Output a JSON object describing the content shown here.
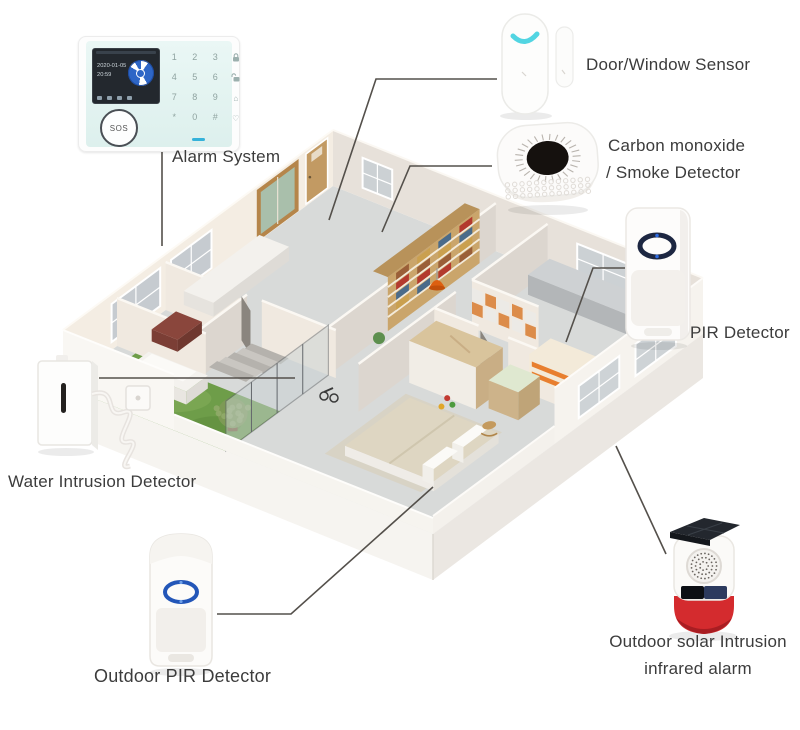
{
  "labels": {
    "alarm_system": "Alarm System",
    "door_window": "Door/Window Sensor",
    "co_line1": "Carbon monoxide",
    "co_line2": "/ Smoke Detector",
    "pir": "PIR Detector",
    "water": "Water Intrusion Detector",
    "outdoor_pir": "Outdoor PIR Detector",
    "solar_line1": "Outdoor solar Intrusion",
    "solar_line2": "infrared alarm"
  },
  "alarm_panel": {
    "screen_date": "2020-01-05",
    "screen_time": "20:59",
    "sos_label": "SOS",
    "keypad_rows": [
      [
        "1",
        "2",
        "3"
      ],
      [
        "4",
        "5",
        "6"
      ],
      [
        "7",
        "8",
        "9"
      ],
      [
        "*",
        "0",
        "#"
      ]
    ],
    "side_icon_names": [
      "arm-lock-icon",
      "disarm-unlock-icon",
      "home-mode-icon",
      "heart-sos-icon"
    ]
  },
  "colors": {
    "label_text": "#3c3c3c",
    "callout_line": "#54504b",
    "lawn_green": "#6e9d49",
    "siren_red": "#d42b2e",
    "led_cyan": "#52d5e2",
    "pir_ring_blue": "#2356b8",
    "accent_orange": "#dd5f10"
  }
}
